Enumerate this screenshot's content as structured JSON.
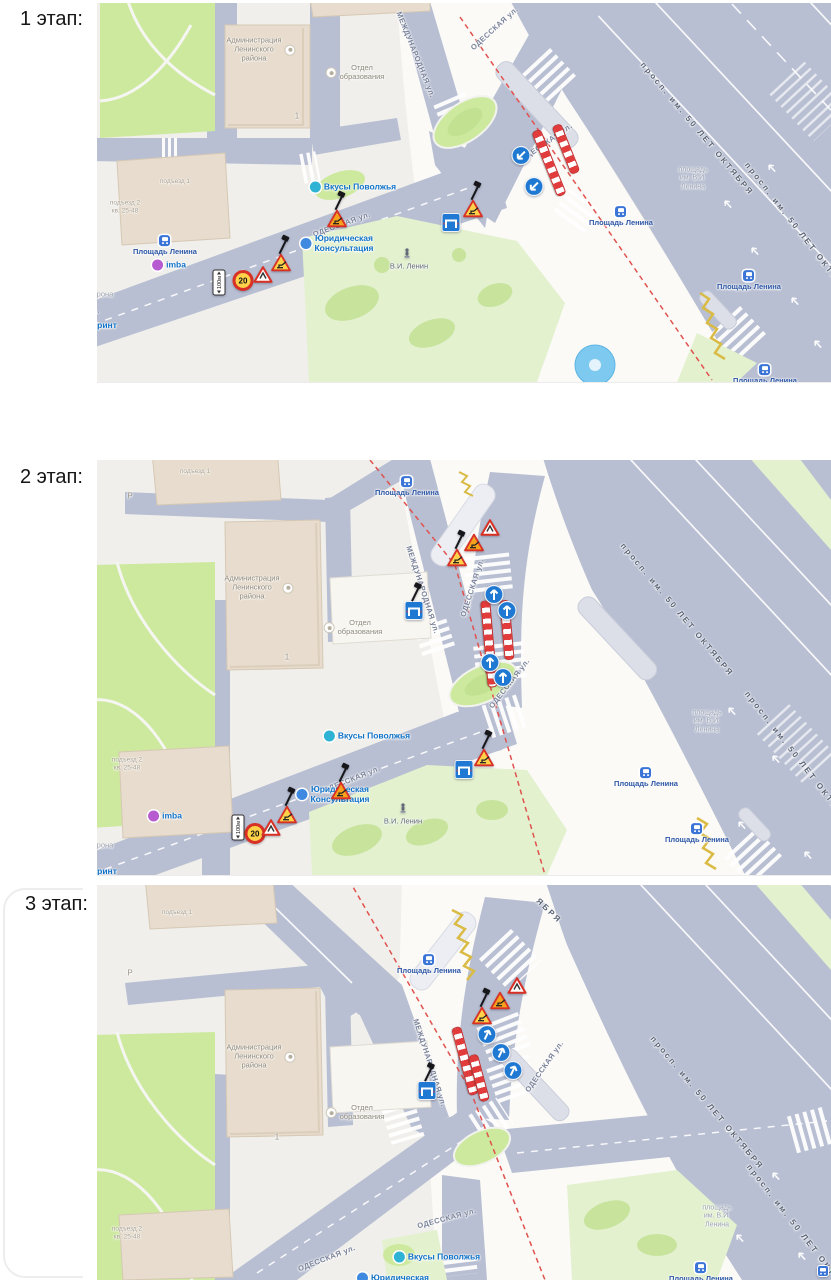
{
  "palette": {
    "land": "#f0efeb",
    "road": "#b8bfd2",
    "plaza": "#fbfaf7",
    "green": "#cde99e",
    "greenPale": "#e3f1cf",
    "greenDark": "#bede8b",
    "bldg": "#e7dccd",
    "bldgEdge": "#d6c8b4",
    "bldgWhite": "#f8f6f1",
    "platform": "#dcdfe8",
    "redDash": "#e0524e",
    "barrier": "#e23b3b",
    "signBlue": "#1f78d1",
    "signRed": "#d93025",
    "signYellow": "#ffd24a",
    "signOrange": "#f6a21d",
    "zigzag": "#d9bb45",
    "busBlue": "#3a74d6",
    "water": "#7ec9ef"
  },
  "stages": [
    {
      "label": "1 этап:",
      "map": {
        "labels": [
          {
            "t": "МЕЖДУНАРОДНАЯ ул.",
            "x": 318,
            "y": 52,
            "r": 68,
            "cls": "street"
          },
          {
            "t": "ОДЕССКАЯ ул.",
            "x": 398,
            "y": 26,
            "r": -42,
            "cls": "street"
          },
          {
            "t": "ОДЕССКАЯ ул.",
            "x": 450,
            "y": 140,
            "r": -35,
            "cls": "street"
          },
          {
            "t": "ОДЕССКАЯ ул.",
            "x": 245,
            "y": 222,
            "r": -20,
            "cls": "street"
          },
          {
            "t": "ОДЕССКАЯ ул.",
            "x": -26,
            "y": 318,
            "r": -20,
            "cls": "street"
          },
          {
            "t": "просп. им. 50 ЛЕТ ОКТЯБРЯ",
            "x": 600,
            "y": 126,
            "r": 50,
            "cls": "avenue"
          },
          {
            "t": "просп. им. 50 ЛЕТ ОКТЯБРЯ",
            "x": 702,
            "y": 228,
            "r": 52,
            "cls": "avenue"
          },
          {
            "t": "площадь\nим. В.И.\nЛенина",
            "x": 596,
            "y": 176,
            "r": 0,
            "cls": "ghost"
          },
          {
            "t": "Площадь Ленина",
            "x": 68,
            "y": 243,
            "r": 0,
            "cls": "bus",
            "ic": "bus",
            "ipos": "top"
          },
          {
            "t": "Площадь Ленина",
            "x": 524,
            "y": 214,
            "r": 0,
            "cls": "bus",
            "ic": "bus",
            "ipos": "top"
          },
          {
            "t": "Площадь Ленина",
            "x": 652,
            "y": 278,
            "r": 0,
            "cls": "bus",
            "ic": "bus",
            "ipos": "top"
          },
          {
            "t": "Площадь Ленина",
            "x": 668,
            "y": 372,
            "r": 0,
            "cls": "bus",
            "ic": "bus",
            "ipos": "top"
          },
          {
            "t": "Вкусы Поволжья",
            "x": 256,
            "y": 184,
            "r": 0,
            "cls": "poi",
            "ic": "#2fb3d4"
          },
          {
            "t": "Юридическая\nКонсультация",
            "x": 240,
            "y": 240,
            "r": 0,
            "cls": "poi",
            "ic": "#3f8ae0"
          },
          {
            "t": "imba",
            "x": 72,
            "y": 262,
            "r": 0,
            "cls": "poi",
            "ic": "#b75bd1"
          },
          {
            "t": "ринт",
            "x": 10,
            "y": 322,
            "r": 0,
            "cls": "poi"
          },
          {
            "t": "рона",
            "x": 8,
            "y": 292,
            "r": 0,
            "cls": "tiny2"
          },
          {
            "t": "Администрация\nЛенинского\nрайона",
            "x": 164,
            "y": 47,
            "r": 0,
            "cls": "bldg",
            "ic": "halo",
            "ipos": "right"
          },
          {
            "t": "Отдел\nобразования",
            "x": 258,
            "y": 70,
            "r": 0,
            "cls": "bldg",
            "ic": "halo",
            "ipos": "left"
          },
          {
            "t": "1",
            "x": 200,
            "y": 113,
            "r": 0,
            "cls": "num"
          },
          {
            "t": "подъезд 1",
            "x": 78,
            "y": 179,
            "r": 0,
            "cls": "tiny"
          },
          {
            "t": "подъезд 2\nкв. 25-48",
            "x": 28,
            "y": 204,
            "r": 0,
            "cls": "tiny"
          },
          {
            "t": "В.И. Ленин",
            "x": 312,
            "y": 264,
            "r": 0,
            "cls": "stat"
          }
        ],
        "signs": [
          {
            "k": "plate",
            "x": 122,
            "y": 282,
            "t": "100м"
          },
          {
            "k": "speed",
            "x": 146,
            "y": 280,
            "t": "20"
          },
          {
            "k": "warn",
            "x": 166,
            "y": 274
          },
          {
            "k": "rw",
            "x": 184,
            "y": 262,
            "pole": 1
          },
          {
            "k": "rw",
            "x": 240,
            "y": 218,
            "c": "o",
            "pole": 1
          },
          {
            "k": "detour",
            "x": 354,
            "y": 222
          },
          {
            "k": "rw",
            "x": 376,
            "y": 208,
            "pole": 1
          },
          {
            "k": "barrow",
            "x": 424,
            "y": 155,
            "r": 225
          },
          {
            "k": "barrow",
            "x": 437,
            "y": 186,
            "r": 225
          },
          {
            "k": "statue",
            "x": 310,
            "y": 252
          }
        ],
        "barriers": [
          {
            "x": 452,
            "y": 160,
            "len": 68,
            "r": 68
          },
          {
            "x": 469,
            "y": 146,
            "len": 50,
            "r": 68
          }
        ]
      }
    },
    {
      "label": "2 этап:",
      "map": {
        "labels": [
          {
            "t": "подъезд 1",
            "x": 98,
            "y": 12,
            "r": 0,
            "cls": "tiny"
          },
          {
            "t": "Площадь Ленина",
            "x": 310,
            "y": 27,
            "r": 0,
            "cls": "bus",
            "ic": "bus",
            "ipos": "top"
          },
          {
            "t": "Администрация\nЛенинского\nрайона",
            "x": 162,
            "y": 128,
            "r": 0,
            "cls": "bldg",
            "ic": "halo",
            "ipos": "right"
          },
          {
            "t": "Отдел\nобразования",
            "x": 256,
            "y": 168,
            "r": 0,
            "cls": "bldg",
            "ic": "halo",
            "ipos": "left"
          },
          {
            "t": "1",
            "x": 190,
            "y": 197,
            "r": 0,
            "cls": "num"
          },
          {
            "t": "Р",
            "x": 33,
            "y": 36,
            "r": 0,
            "cls": "num"
          },
          {
            "t": "МЕЖДУНАРОДНАЯ ул.",
            "x": 325,
            "y": 130,
            "r": 72,
            "cls": "street"
          },
          {
            "t": "ОДЕССКАЯ ул.",
            "x": 376,
            "y": 128,
            "r": -72,
            "cls": "street"
          },
          {
            "t": "ОДЕССКАЯ ул.",
            "x": 413,
            "y": 224,
            "r": -52,
            "cls": "street"
          },
          {
            "t": "ОДЕССКАЯ ул.",
            "x": 255,
            "y": 320,
            "r": -22,
            "cls": "street"
          },
          {
            "t": "просп. им. 50 ЛЕТ ОКТЯБРЯ",
            "x": 580,
            "y": 150,
            "r": 50,
            "cls": "avenue"
          },
          {
            "t": "просп. им. 50 ЛЕТ ОКТЯБРЯ",
            "x": 702,
            "y": 300,
            "r": 52,
            "cls": "avenue"
          },
          {
            "t": "площадь\nим. В.И.\nЛенина",
            "x": 610,
            "y": 262,
            "r": 0,
            "cls": "ghost"
          },
          {
            "t": "Площадь Ленина",
            "x": 549,
            "y": 318,
            "r": 0,
            "cls": "bus",
            "ic": "bus",
            "ipos": "top"
          },
          {
            "t": "Площадь Ленина",
            "x": 600,
            "y": 374,
            "r": 0,
            "cls": "bus",
            "ic": "bus",
            "ipos": "top"
          },
          {
            "t": "Вкусы Поволжья",
            "x": 270,
            "y": 276,
            "r": 0,
            "cls": "poi",
            "ic": "#2fb3d4"
          },
          {
            "t": "Юридическая\nКонсультация",
            "x": 236,
            "y": 334,
            "r": 0,
            "cls": "poi",
            "ic": "#3f8ae0"
          },
          {
            "t": "imba",
            "x": 68,
            "y": 356,
            "r": 0,
            "cls": "poi",
            "ic": "#b75bd1"
          },
          {
            "t": "рона",
            "x": 8,
            "y": 386,
            "r": 0,
            "cls": "tiny2"
          },
          {
            "t": "ринт",
            "x": 10,
            "y": 411,
            "r": 0,
            "cls": "poi"
          },
          {
            "t": "В.И. Ленин",
            "x": 306,
            "y": 362,
            "r": 0,
            "cls": "stat"
          },
          {
            "t": "подъезд 2\nкв. 25-48",
            "x": 30,
            "y": 304,
            "r": 0,
            "cls": "tiny"
          }
        ],
        "signs": [
          {
            "k": "warn",
            "x": 393,
            "y": 70
          },
          {
            "k": "rw",
            "x": 377,
            "y": 85,
            "c": "o"
          },
          {
            "k": "rw",
            "x": 360,
            "y": 100,
            "pole": 1
          },
          {
            "k": "barrow",
            "x": 397,
            "y": 137,
            "r": 0
          },
          {
            "k": "barrow",
            "x": 410,
            "y": 153,
            "r": 0
          },
          {
            "k": "barrow",
            "x": 393,
            "y": 205,
            "r": 0
          },
          {
            "k": "barrow",
            "x": 406,
            "y": 220,
            "r": 0
          },
          {
            "k": "detour",
            "x": 317,
            "y": 153,
            "pole": 1
          },
          {
            "k": "plate",
            "x": 141,
            "y": 370,
            "t": "100м"
          },
          {
            "k": "speed",
            "x": 158,
            "y": 376,
            "t": "20"
          },
          {
            "k": "warn",
            "x": 174,
            "y": 370
          },
          {
            "k": "rw",
            "x": 190,
            "y": 357,
            "pole": 1
          },
          {
            "k": "rw",
            "x": 244,
            "y": 333,
            "c": "o",
            "pole": 1
          },
          {
            "k": "detour",
            "x": 367,
            "y": 312
          },
          {
            "k": "rw",
            "x": 387,
            "y": 300,
            "pole": 1
          },
          {
            "k": "statue",
            "x": 306,
            "y": 350
          }
        ],
        "barriers": [
          {
            "x": 392,
            "y": 184,
            "len": 85,
            "r": 85
          },
          {
            "x": 410,
            "y": 170,
            "len": 58,
            "r": 85
          }
        ]
      }
    },
    {
      "label": "3 этап:",
      "map": {
        "labels": [
          {
            "t": "подъезд 1",
            "x": 80,
            "y": 28,
            "r": 0,
            "cls": "tiny"
          },
          {
            "t": "Р",
            "x": 33,
            "y": 88,
            "r": 0,
            "cls": "num"
          },
          {
            "t": "Площадь Ленина",
            "x": 332,
            "y": 80,
            "r": 0,
            "cls": "bus",
            "ic": "bus",
            "ipos": "top"
          },
          {
            "t": "ЯБРЯ",
            "x": 452,
            "y": 26,
            "r": 44,
            "cls": "avenue"
          },
          {
            "t": "Администрация\nЛенинского\nрайона",
            "x": 164,
            "y": 172,
            "r": 0,
            "cls": "bldg",
            "ic": "halo",
            "ipos": "right"
          },
          {
            "t": "Отдел\nобразования",
            "x": 258,
            "y": 228,
            "r": 0,
            "cls": "bldg",
            "ic": "halo",
            "ipos": "left"
          },
          {
            "t": "1",
            "x": 180,
            "y": 252,
            "r": 0,
            "cls": "num"
          },
          {
            "t": "МЕЖДУНАРОДНАЯ ул.",
            "x": 332,
            "y": 178,
            "r": 72,
            "cls": "street"
          },
          {
            "t": "ОДЕССКАЯ ул.",
            "x": 448,
            "y": 182,
            "r": -55,
            "cls": "street"
          },
          {
            "t": "ОДЕССКАЯ ул.",
            "x": 350,
            "y": 334,
            "r": -15,
            "cls": "street"
          },
          {
            "t": "ОДЕССКАЯ ул.",
            "x": 230,
            "y": 374,
            "r": -21,
            "cls": "street"
          },
          {
            "t": "просп. им. 50 ЛЕТ ОКТЯБРЯ",
            "x": 610,
            "y": 218,
            "r": 50,
            "cls": "avenue"
          },
          {
            "t": "просп. им. 50 ЛЕТ ОКТЯБРЯ",
            "x": 704,
            "y": 348,
            "r": 52,
            "cls": "avenue"
          },
          {
            "t": "площадь\nим. В.И.\nЛенина",
            "x": 620,
            "y": 332,
            "r": 0,
            "cls": "ghost"
          },
          {
            "t": "Площадь Ленина",
            "x": 604,
            "y": 388,
            "r": 0,
            "cls": "bus",
            "ic": "bus",
            "ipos": "top"
          },
          {
            "t": "Вкусы Поволжья",
            "x": 340,
            "y": 372,
            "r": 0,
            "cls": "poi",
            "ic": "#2fb3d4"
          },
          {
            "t": "Юридическая",
            "x": 296,
            "y": 393,
            "r": 0,
            "cls": "poi",
            "ic": "#3f8ae0"
          },
          {
            "t": "подъезд 2\nкв. 25-48",
            "x": 30,
            "y": 348,
            "r": 0,
            "cls": "tiny"
          }
        ],
        "signs": [
          {
            "k": "warn",
            "x": 420,
            "y": 103
          },
          {
            "k": "rw",
            "x": 403,
            "y": 118,
            "c": "o"
          },
          {
            "k": "rw",
            "x": 385,
            "y": 133,
            "pole": 1
          },
          {
            "k": "barrow",
            "x": 390,
            "y": 152,
            "r": 25
          },
          {
            "k": "barrow",
            "x": 404,
            "y": 170,
            "r": 25
          },
          {
            "k": "barrow",
            "x": 416,
            "y": 188,
            "r": 25
          },
          {
            "k": "detour",
            "x": 330,
            "y": 208,
            "pole": 1
          },
          {
            "k": "busicon",
            "x": 726,
            "y": 388
          }
        ],
        "barriers": [
          {
            "x": 368,
            "y": 176,
            "len": 68,
            "r": 75
          },
          {
            "x": 382,
            "y": 193,
            "len": 46,
            "r": 75
          }
        ]
      }
    }
  ]
}
